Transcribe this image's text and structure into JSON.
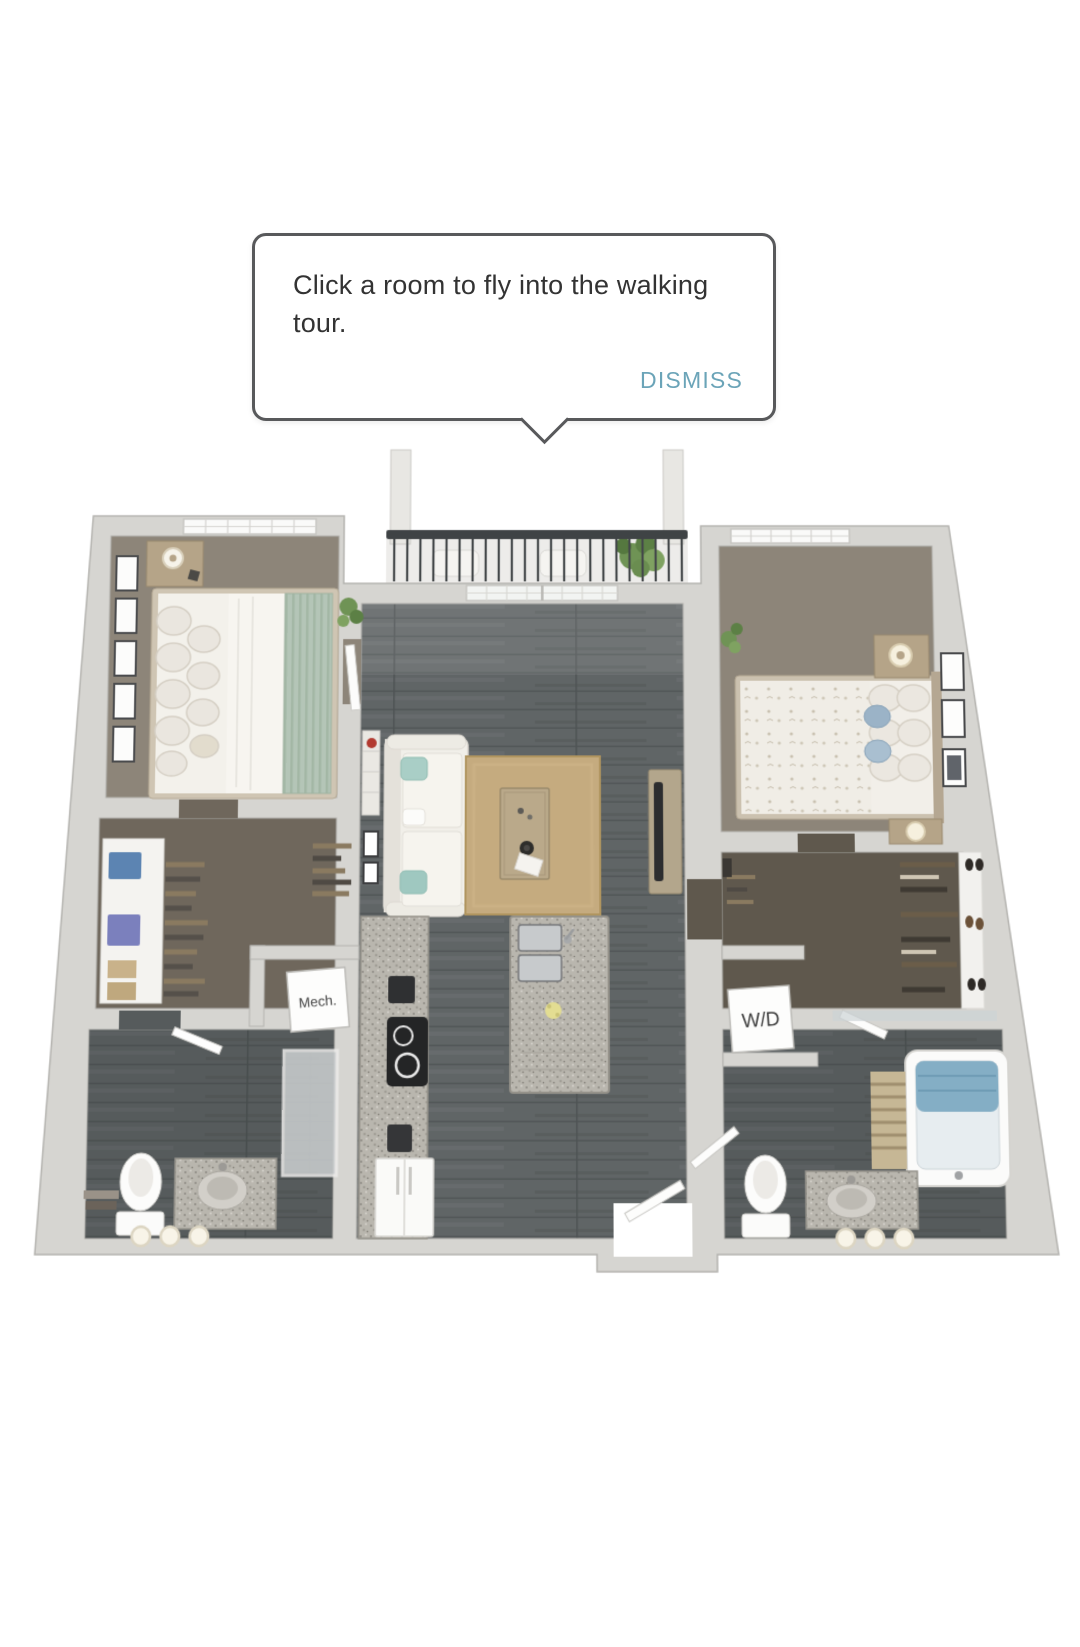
{
  "tooltip": {
    "message": "Click a room to fly into the walking tour.",
    "dismiss_label": "DISMISS"
  },
  "floor_plan": {
    "labels": {
      "mech": "Mech.",
      "wd": "W/D"
    }
  },
  "colors": {
    "tooltip_border": "#58595B",
    "tooltip_text": "#333333",
    "dismiss_blue": "#6BA4B8",
    "wall": "#D6D5D1",
    "wall_edge": "#B4B3AF",
    "carpet": "#8D8579",
    "wood_floor": "#606566",
    "closet_floor_left": "#6F675C",
    "closet_floor_right": "#5F584D",
    "rug": "#C5AB7F",
    "railing": "#3F4345",
    "plant_green": "#6F9355",
    "granite": "#B9B6AE",
    "sage_accent": "#B4C5B7",
    "blue_pillow": "#9BB3C7",
    "teal_pillow": "#A9CEC6",
    "towel_blue": "#84AEC5",
    "red_accent": "#B23A30"
  }
}
